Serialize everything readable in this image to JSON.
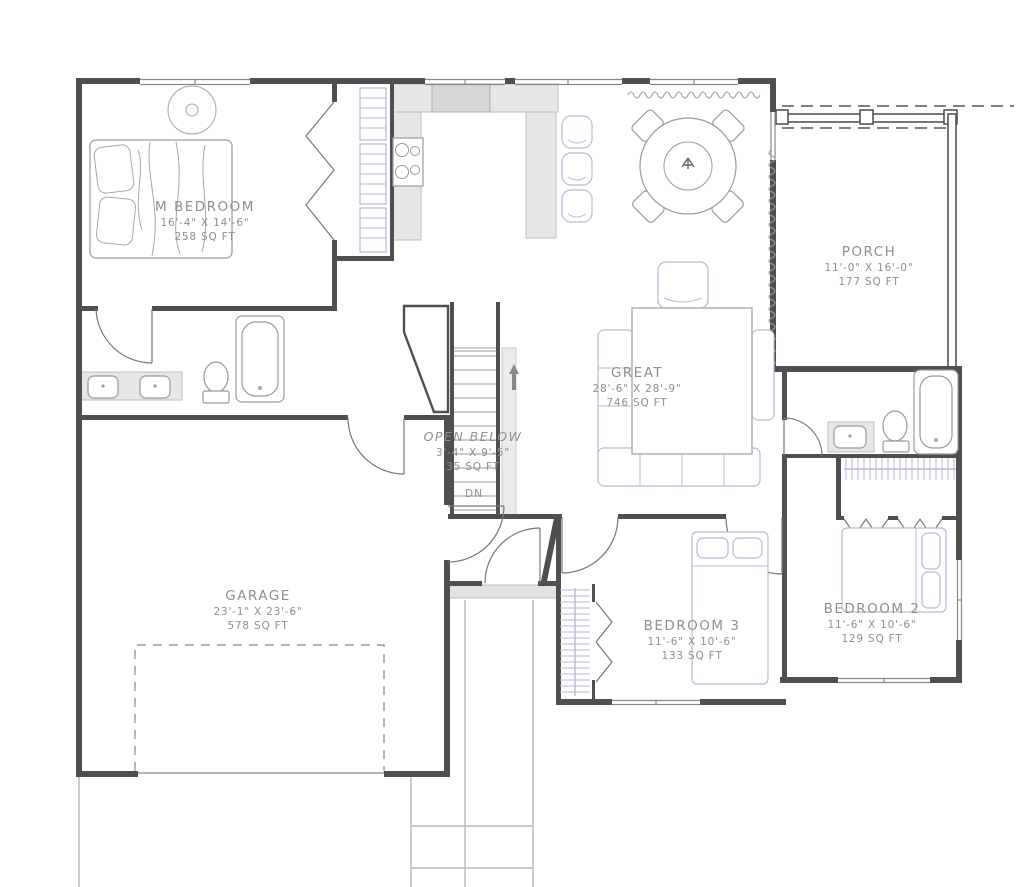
{
  "drawing": {
    "type": "residential-floor-plan",
    "colors": {
      "wall": "#4f4f4f",
      "furniture_accent": "#b6bad8",
      "counter_fill": "#e7e7e7",
      "label_text": "#8f8f8f",
      "background": "#ffffff"
    }
  },
  "rooms": [
    {
      "name": "M BEDROOM",
      "dims": "16'-4\" X 14'-6\"",
      "area": "258 SQ FT"
    },
    {
      "name": "PORCH",
      "dims": "11'-0\" X 16'-0\"",
      "area": "177 SQ FT"
    },
    {
      "name": "GREAT",
      "dims": "28'-6\" X 28'-9\"",
      "area": "746 SQ FT"
    },
    {
      "name": "OPEN BELOW",
      "dims": "3'-4\" X 9'-5\"",
      "area": "35 SQ FT"
    },
    {
      "name": "GARAGE",
      "dims": "23'-1\" X 23'-6\"",
      "area": "578 SQ FT"
    },
    {
      "name": "BEDROOM 3",
      "dims": "11'-6\" X 10'-6\"",
      "area": "133 SQ FT"
    },
    {
      "name": "BEDROOM 2",
      "dims": "11'-6\" X 10'-6\"",
      "area": "129 SQ FT"
    }
  ],
  "stairs": {
    "direction_label": "DN"
  }
}
